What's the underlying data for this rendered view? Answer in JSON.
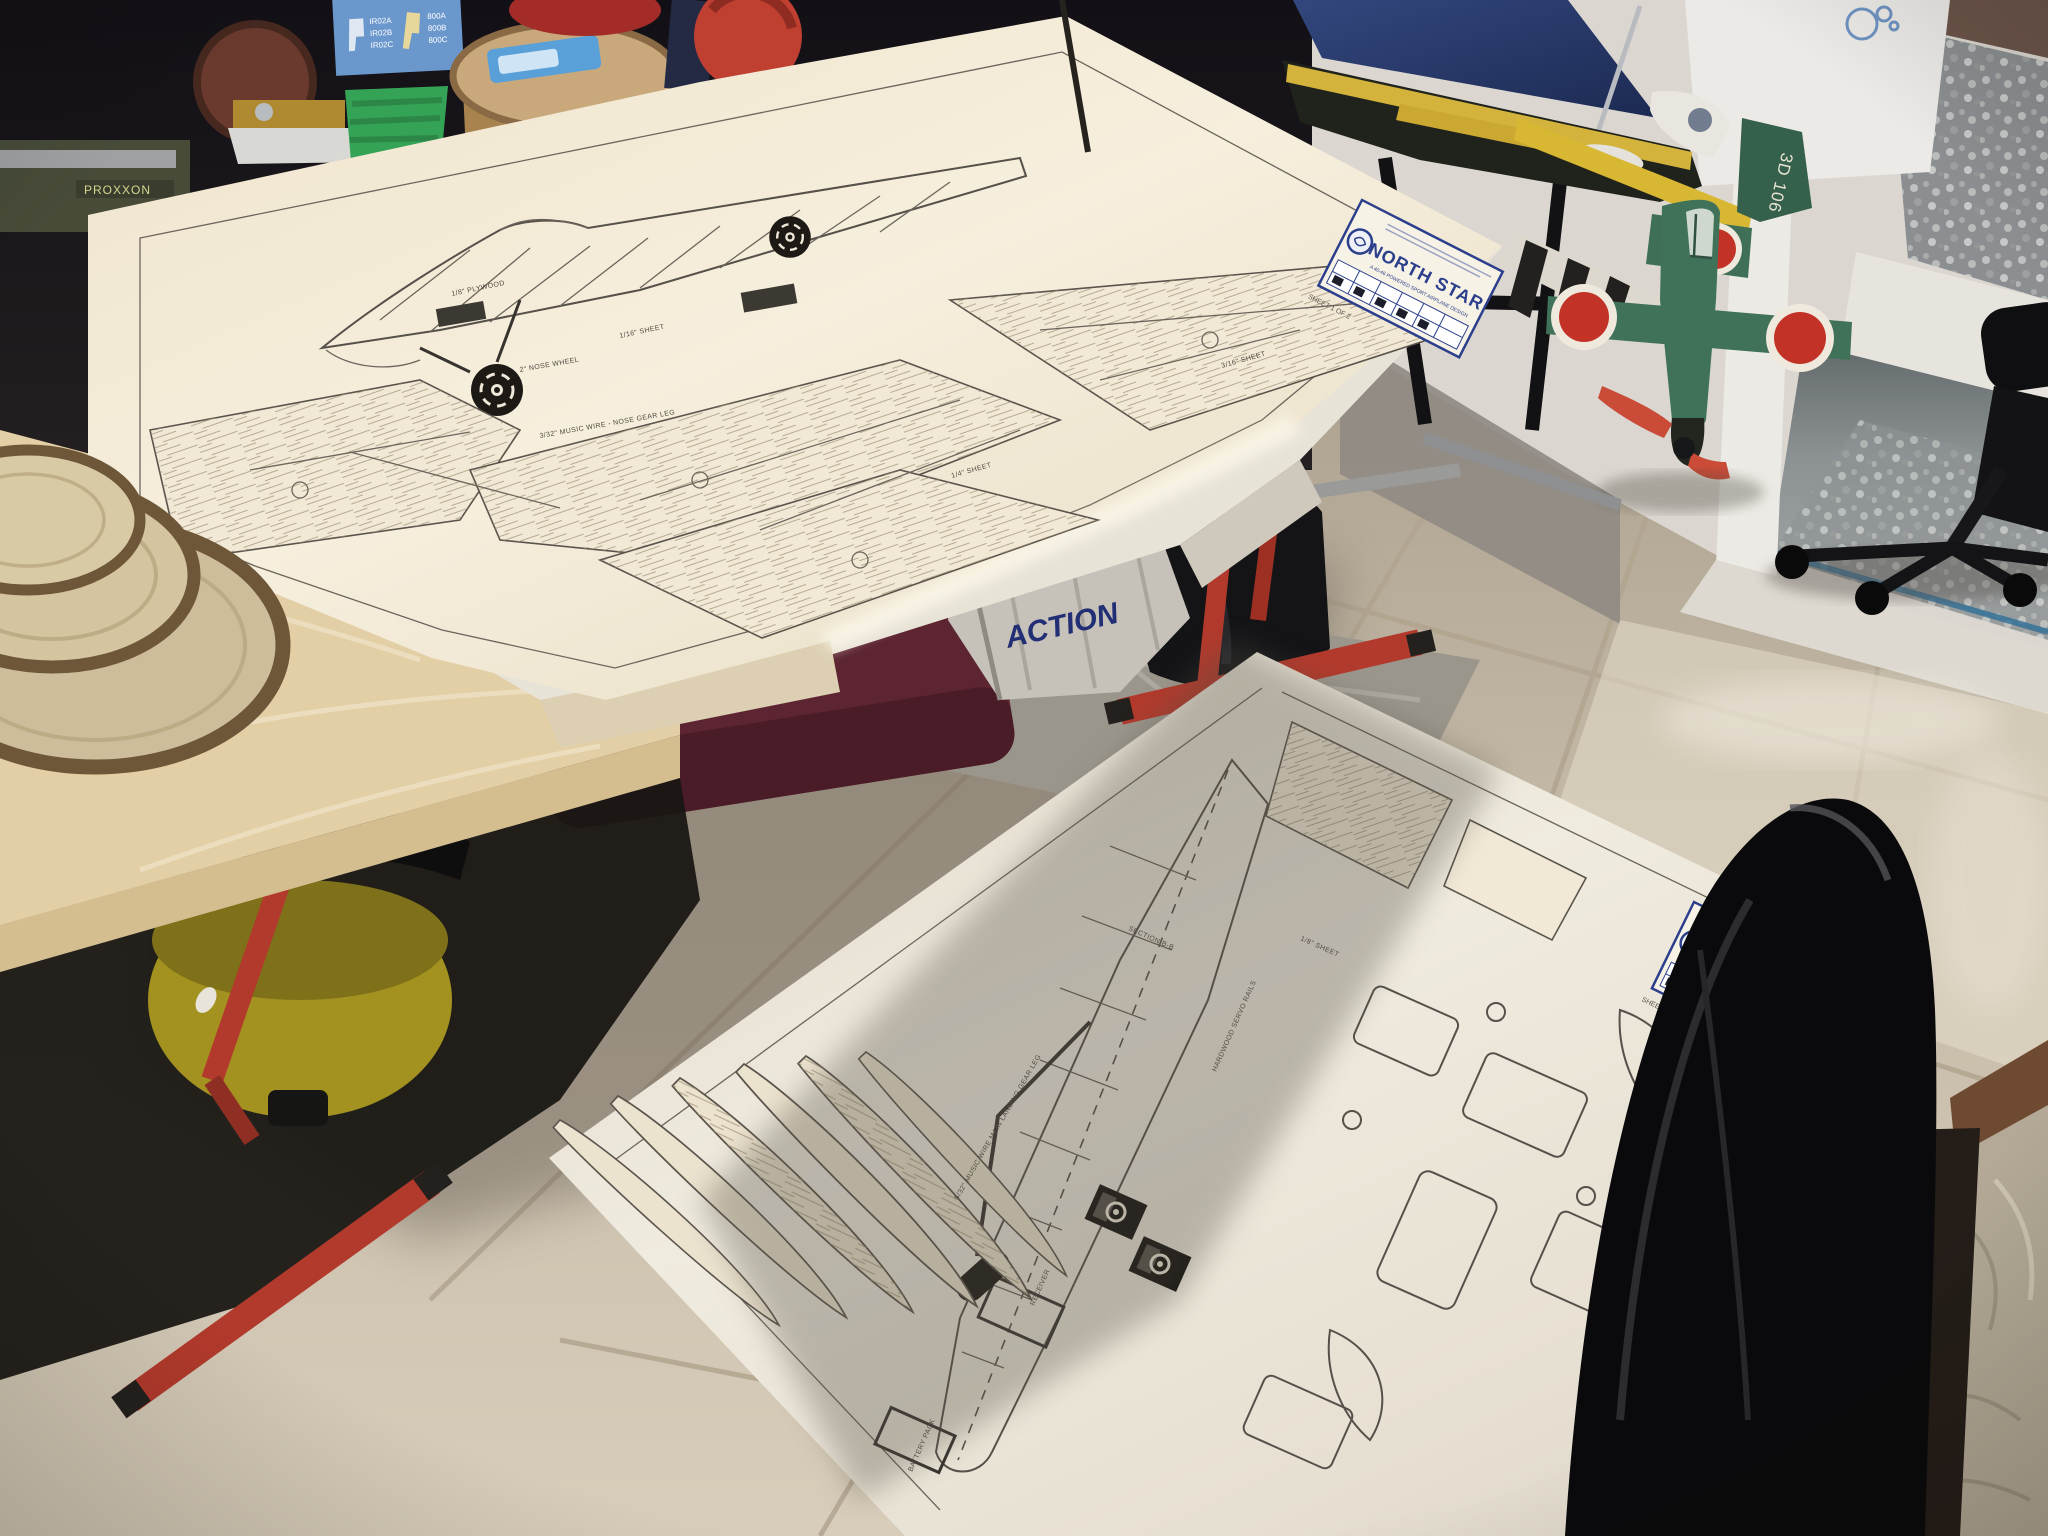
{
  "plans": {
    "brand": "NORTH STAR",
    "subtitle": "A 40-46 POWERED SPORT AIRPLANE DESIGN",
    "logo_icon": "winged-crest-logo",
    "sheet1": {
      "sheet_label": "SHEET 1 OF 2",
      "annotations": [
        "1/16\" SHEET",
        "1/8\" PLYWOOD",
        "3/32\" MUSIC WIRE - NOSE GEAR LEG",
        "2\" NOSE WHEEL",
        "1/4\" SHEET",
        "3/16\" SHEET"
      ]
    },
    "sheet2": {
      "sheet_label": "SHEET 2 OF 2",
      "annotations": [
        "RECEIVER",
        "BATTERY PACK",
        "HARDWOOD SERVO RAILS",
        "5/32\" MUSIC WIRE MAIN LANDING GEAR LEG",
        "SECTION B-B",
        "1/8\" SHEET"
      ]
    }
  },
  "workshop": {
    "machine_label": "PROXXON",
    "charger_box_left_models": [
      "IR02A",
      "IR02B",
      "IR02C"
    ],
    "charger_box_right_models": [
      "800A",
      "800B",
      "800C"
    ],
    "bag_label": "ACTION",
    "bag_label_partial": "ON"
  },
  "models": {
    "fighter_tail_code": "3D 106",
    "fighter_marking_icon": "hinomaru-roundel",
    "sailboat_icon": "model-yacht-hull"
  },
  "colors": {
    "paper": "#f2ead9",
    "plan_ink": "#55504a",
    "brand_blue": "#2c3f8c",
    "trestle_red": "#b23a2c",
    "vacuum_yellow": "#b3a22c",
    "bag_text_navy": "#232f74",
    "roundel_red": "#c23227",
    "fighter_green": "#40725a",
    "sail_navy": "#2c3e74",
    "boat_deck_yellow": "#d3b33c",
    "floor_tile": "#d2c7b4"
  }
}
